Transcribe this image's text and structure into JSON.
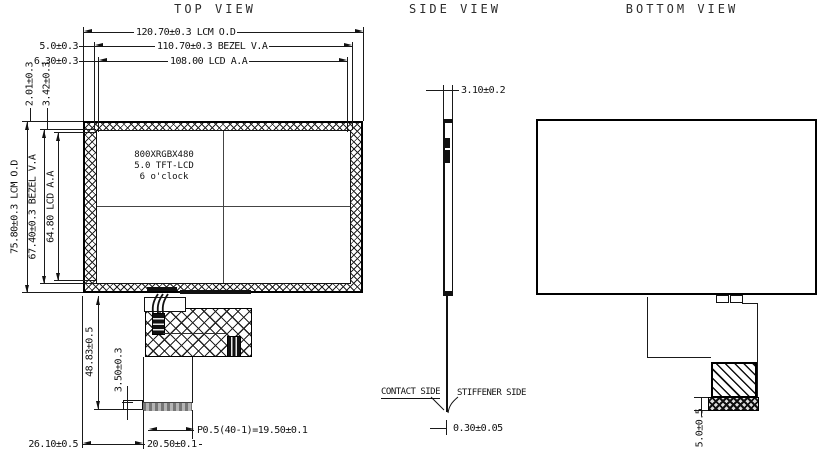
{
  "titles": {
    "top": "TOP VIEW",
    "side": "SIDE VIEW",
    "bottom": "BOTTOM VIEW"
  },
  "top_view": {
    "panel_label": {
      "line1": "800XRGBX480",
      "line2": "5.0 TFT-LCD",
      "line3": "6 o'clock"
    },
    "dims": {
      "lcm_od_width": "120.70±0.3 LCM O.D",
      "bezel_va_width": "110.70±0.3 BEZEL V.A",
      "lcd_aa_width": "108.00 LCD A.A",
      "bezel_top_gap": "5.0±0.3",
      "lcd_top_gap": "6.30±0.3",
      "bezel_side_gap": "2.01±0.3",
      "lcd_side_gap": "3.42±0.3",
      "lcm_od_height": "75.80±0.3 LCM O.D",
      "bezel_va_height": "67.40±0.3 BEZEL V.A",
      "lcd_aa_height": "64.80 LCD A.A",
      "fpc_length": "48.83±0.5",
      "contact_length": "3.50±0.3",
      "connector_pitch": "P0.5(40-1)=19.50±0.1",
      "connector_width": "20.50±0.1",
      "connector_offset": "26.10±0.5"
    }
  },
  "side_view": {
    "dims": {
      "module_thickness": "3.10±0.2",
      "fpc_thickness": "0.30±0.05"
    },
    "labels": {
      "contact_side": "CONTACT SIDE",
      "stiffener_side": "STIFFENER SIDE"
    }
  },
  "bottom_view": {
    "dims": {
      "stiffener_height": "5.0±0.5"
    }
  },
  "colors": {
    "line": "#1a1a1a",
    "background": "#ffffff"
  }
}
